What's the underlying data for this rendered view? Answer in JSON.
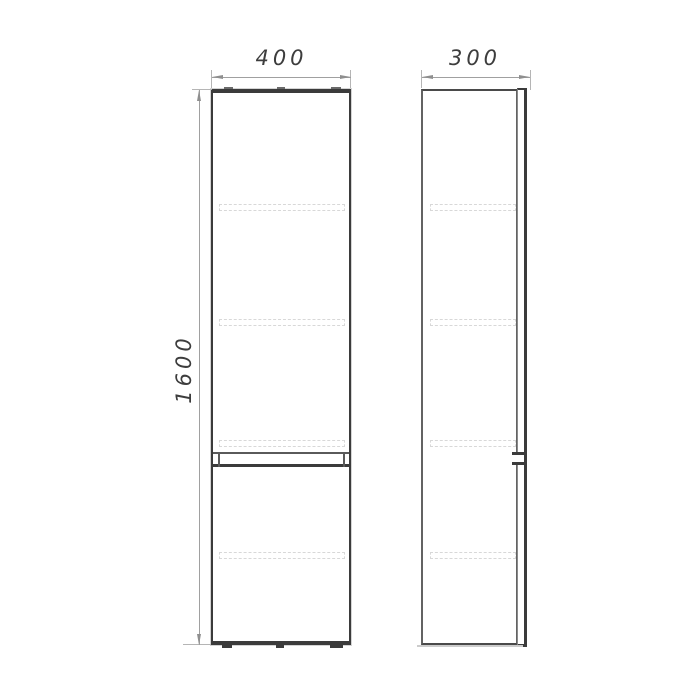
{
  "drawing": {
    "kind": "cabinet-orthographic-dimension-drawing",
    "dimensions": {
      "width_label": "400",
      "depth_label": "300",
      "height_label": "1600"
    },
    "views": {
      "front": {
        "shelf_hidden_lines": 4,
        "door_sections": 2
      },
      "side": {
        "shelf_hidden_lines": 4
      }
    },
    "colors": {
      "background": "#ffffff",
      "outline": "#3b3b3b",
      "hidden_line": "#d8d8d8",
      "dimension_line": "#a0a0a0",
      "dimension_text": "#3d3d3d"
    }
  }
}
